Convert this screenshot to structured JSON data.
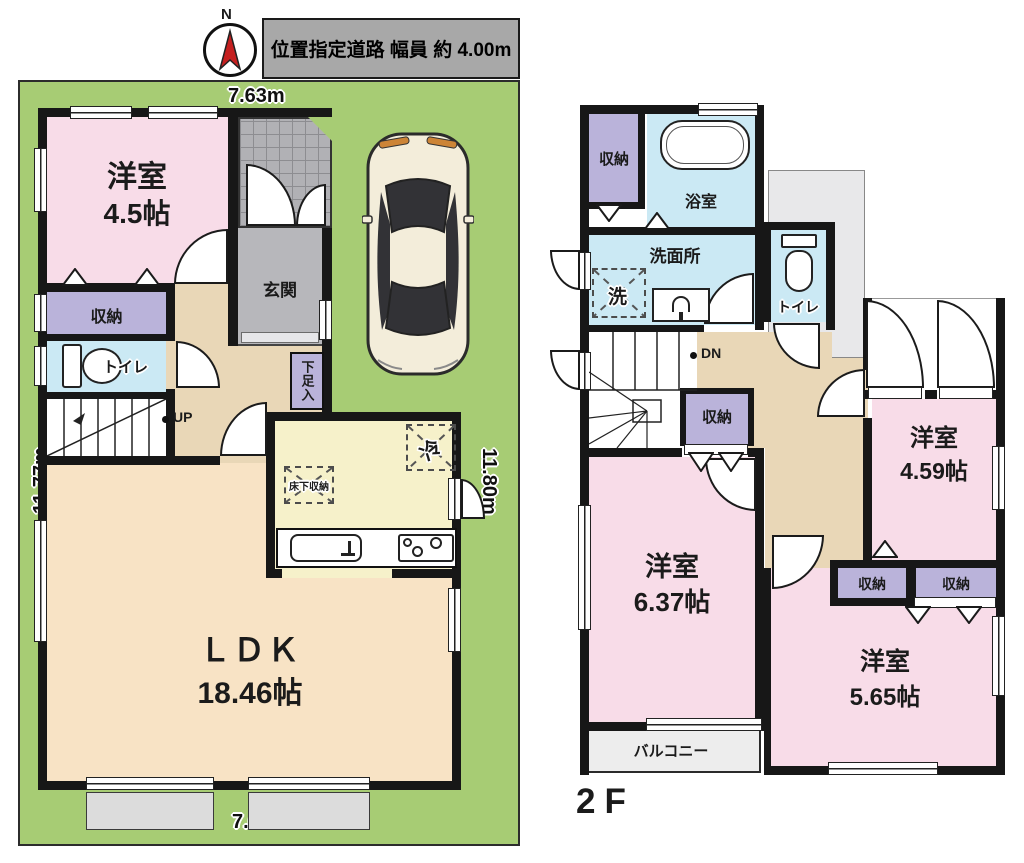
{
  "header": {
    "compass_n": "N",
    "road_label": "位置指定道路 幅員 約 4.00m"
  },
  "f1": {
    "dim_top": "7.63m",
    "dim_bottom": "7.66m",
    "dim_left": "11.77m",
    "dim_right": "11.80m",
    "room1_name": "洋室",
    "room1_size": "4.5帖",
    "closet": "収納",
    "toilet": "トイレ",
    "entrance": "玄関",
    "shoe_closet": "下足入",
    "stairs_up": "UP",
    "ldk_name": "ＬＤＫ",
    "ldk_size": "18.46帖",
    "underfloor_storage": "床下収納",
    "fridge": "冷"
  },
  "f2": {
    "floor_label": "2F",
    "closet": "収納",
    "bathroom": "浴室",
    "washroom": "洗面所",
    "laundry": "洗",
    "toilet": "トイレ",
    "stairs_down": "DN",
    "room2_name": "洋室",
    "room2_size": "6.37帖",
    "room3_name": "洋室",
    "room3_size": "4.59帖",
    "room4_name": "洋室",
    "room4_size": "5.65帖",
    "balcony": "バルコニー"
  }
}
